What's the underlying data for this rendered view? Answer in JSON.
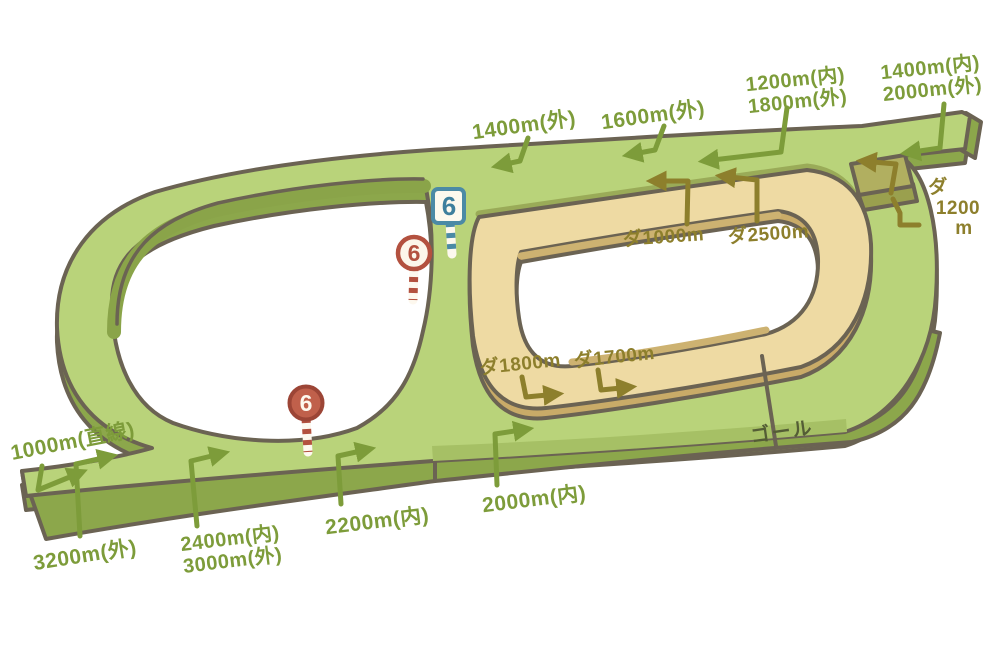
{
  "illustration": {
    "type": "racecourse-course-map",
    "background": "#ffffff",
    "colors": {
      "turf_top": "#b9d37a",
      "turf_mid_band": "#a6c065",
      "turf_side": "#8ca74b",
      "dirt_top": "#eedaa3",
      "dirt_side": "#c9ab68",
      "dirt_chute": "#b1af60",
      "outline": "#6b6353",
      "turf_label": "#7d9c3a",
      "dirt_label": "#8d7f2c",
      "goal_label": "#545d35",
      "marker_red": "#b3513f",
      "marker_blue": "#4b8aa5"
    }
  },
  "labels": {
    "turf": {
      "s1400_out": "1400m(外)",
      "s1600_out": "1600m(外)",
      "s1200_in": "1200m(内)",
      "s1800_out": "1800m(外)",
      "s1400_in": "1400m(内)",
      "s2000_out": "2000m(外)",
      "s1000_straight": "1000m(直線)",
      "s3200_out": "3200m(外)",
      "s2400_in": "2400m(内)",
      "s3000_out": "3000m(外)",
      "s2200_in": "2200m(内)",
      "s2000_in": "2000m(内)"
    },
    "dirt": {
      "d1000": "ダ1000m",
      "d2500": "ダ2500m",
      "d1800": "ダ1800m",
      "d1700": "ダ1700m",
      "d1200_line1": "ダ",
      "d1200_line2": "1200",
      "d1200_line3": "m"
    },
    "goal": "ゴール"
  },
  "markers": {
    "dirt_600": {
      "number": "6",
      "shape": "square",
      "color": "blue"
    },
    "turf_inner_600": {
      "number": "6",
      "shape": "circle",
      "color": "red"
    },
    "turf_outer_600": {
      "number": "6",
      "shape": "circle",
      "color": "red"
    }
  }
}
